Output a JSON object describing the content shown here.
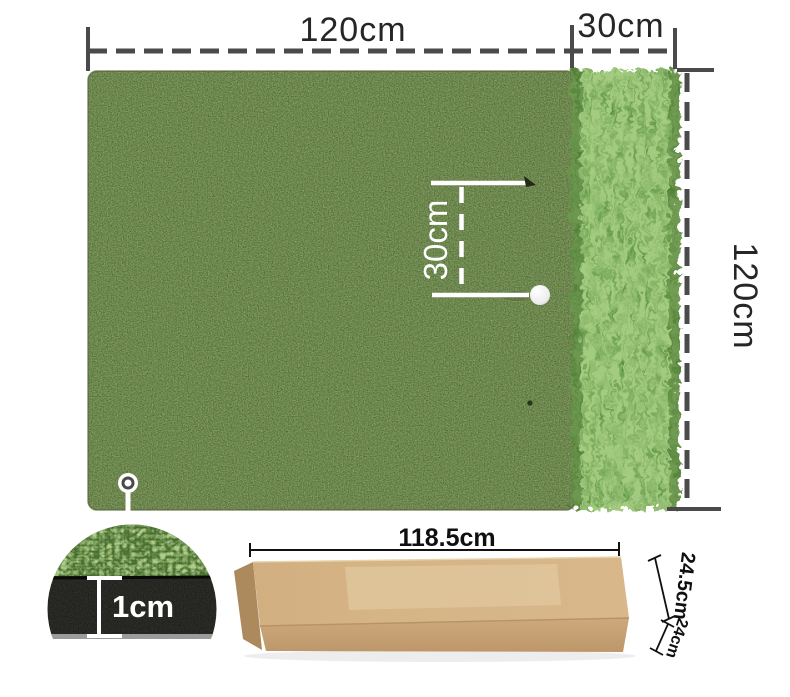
{
  "diagram": {
    "type": "product-dimension-diagram",
    "subject": "golf practice hitting mat with rough strip and shipping box",
    "mat": {
      "width_label": "120cm",
      "rough_strip_width_label": "30cm",
      "height_label": "120cm",
      "ball_distance_label": "30cm",
      "thickness_label": "1cm"
    },
    "box": {
      "length_label": "118.5cm",
      "height_label": "24.5cm",
      "depth_label": "24cm"
    },
    "colors": {
      "mat_green": "#6f7e48",
      "rough_green": "#4f8c30",
      "closeup_grass_green": "#47702a",
      "rubber_black": "#181818",
      "dimension_gray": "#4a4a4a",
      "white_marking": "#ffffff",
      "cardboard_tan": "#d5b486",
      "cardboard_front": "#c9a477",
      "cardboard_end": "#ad8a5e"
    }
  }
}
